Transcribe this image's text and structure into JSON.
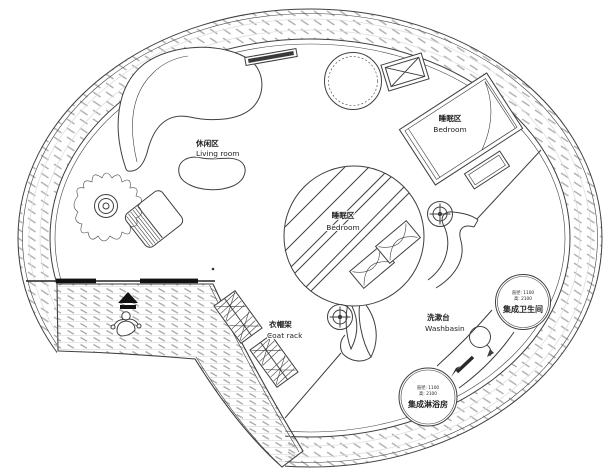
{
  "floorplan": {
    "background": "#ffffff",
    "colors": {
      "wall_line": "#3f3f3f",
      "hatch": "#b5b5b5",
      "door_bar": "#111111",
      "text": "#222222"
    },
    "areas": {
      "living": {
        "zh": "休闲区",
        "en": "Living room"
      },
      "bedroom_upper": {
        "zh": "睡眠区",
        "en": "Bedroom"
      },
      "bedroom_loft": {
        "zh": "睡眠区",
        "en": "Bedroom"
      },
      "coat_rack": {
        "zh": "衣帽架",
        "en": "Coat rack"
      },
      "washbasin": {
        "zh": "洗漱台",
        "en": "Washbasin"
      }
    },
    "pods": {
      "toilet": {
        "name": "集成卫生间",
        "dim_line1": "直径: 1100",
        "dim_line2": "高: 2100"
      },
      "shower": {
        "name": "集成淋浴房",
        "dim_line1": "直径: 1100",
        "dim_line2": "高: 2100"
      }
    },
    "icons": {
      "downlight": "crosshair-target",
      "entry_arrow": "solid-up-arrow",
      "person": "person-top-view",
      "sink": "round-basin-with-tap",
      "ac_unit": "crossed-box",
      "plant": "potted-plant"
    }
  }
}
